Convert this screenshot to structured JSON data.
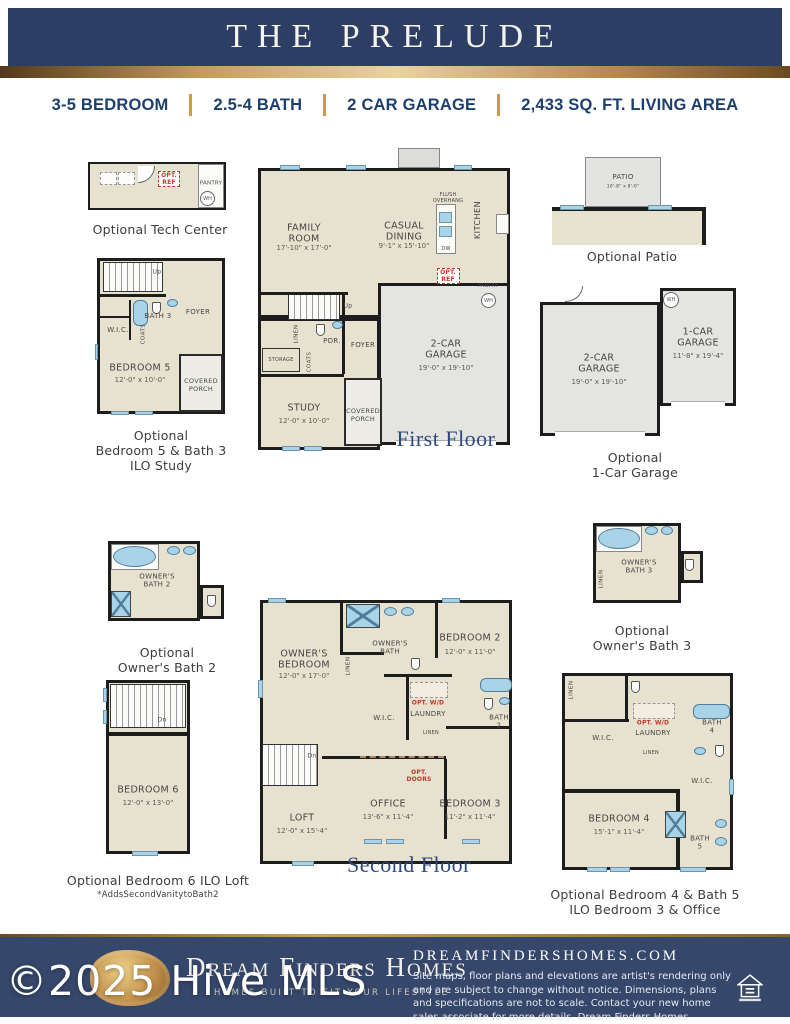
{
  "header": {
    "title": "THE PRELUDE"
  },
  "specs": [
    "3-5 BEDROOM",
    "2.5-4 BATH",
    "2 CAR GARAGE",
    "2,433 SQ. FT. LIVING AREA"
  ],
  "floors": {
    "first": "First Floor",
    "second": "Second Floor"
  },
  "plans": {
    "tech": {
      "caption": "Optional Tech Center",
      "opt_ref": "OPT.\nREF",
      "pantry": "PANTRY",
      "wh": "WH"
    },
    "bed5": {
      "caption": "Optional\nBedroom 5 & Bath 3\nILO Study",
      "up": "Up",
      "bath": "BATH 3",
      "foyer": "FOYER",
      "wic": "W.I.C.",
      "coats": "COATS",
      "name": "BEDROOM 5",
      "dim": "12'-0\" x 10'-0\"",
      "porch": "COVERED\nPORCH"
    },
    "first": {
      "family": "FAMILY\nROOM",
      "family_dim": "17'-10\" x 17'-0\"",
      "dining": "CASUAL\nDINING",
      "dining_dim": "9'-1\" x 15'-10\"",
      "kitchen": "KITCHEN",
      "flush": "FLUSH\nOVERHANG",
      "dw": "DW",
      "opt_ref": "OPT.\nREF",
      "pantry": "PANTRY",
      "wh": "WH",
      "garage": "2-CAR\nGARAGE",
      "garage_dim": "19'-0\" x 19'-10\"",
      "linen": "LINEN",
      "pdr": "PDR.",
      "foyer": "FOYER",
      "storage": "STORAGE",
      "coats": "COATS",
      "study": "STUDY",
      "study_dim": "12'-0\" x 10'-0\"",
      "porch": "COVERED\nPORCH",
      "up": "Up"
    },
    "patio": {
      "caption": "Optional Patio",
      "name": "PATIO",
      "dim": "10'-8\" x 8'-0\""
    },
    "garage_opt": {
      "caption": "Optional\n1-Car Garage",
      "wh": "WH",
      "g2": "2-CAR\nGARAGE",
      "g2_dim": "19'-0\" x 19'-10\"",
      "g1": "1-CAR\nGARAGE",
      "g1_dim": "11'-8\" x 19'-4\""
    },
    "obath2": {
      "caption": "Optional\nOwner's Bath 2",
      "name": "OWNER'S\nBATH 2"
    },
    "bed6": {
      "caption": "Optional Bedroom 6 ILO Loft",
      "note": "*AddsSecondVanitytoBath2",
      "dn": "Dn",
      "name": "BEDROOM 6",
      "dim": "12'-0\" x 13'-0\""
    },
    "second": {
      "owner": "OWNER'S\nBEDROOM",
      "owner_dim": "12'-0\" x 17'-0\"",
      "obath": "OWNER'S\nBATH",
      "linen1": "LINEN",
      "bed2": "BEDROOM 2",
      "bed2_dim": "12'-0\" x 11'-0\"",
      "optwd": "OPT. W/D",
      "laundry": "LAUNDRY",
      "wic": "W.I.C.",
      "linen2": "LINEN",
      "bath2": "BATH\n2",
      "dn": "Dn",
      "loft": "LOFT",
      "loft_dim": "12'-0\" x 15'-4\"",
      "office": "OFFICE",
      "office_dim": "13'-6\" x 11'-4\"",
      "optdoors": "OPT.\nDOORS",
      "bed3": "BEDROOM 3",
      "bed3_dim": "11'-2\" x 11'-4\""
    },
    "obath3": {
      "caption": "Optional\nOwner's Bath 3",
      "name": "OWNER'S\nBATH 3",
      "linen": "LINEN"
    },
    "bed4": {
      "caption": "Optional Bedroom 4 & Bath 5\nILO Bedroom 3 & Office",
      "linen1": "LINEN",
      "wic1": "W.I.C.",
      "optwd": "OPT. W/D",
      "laundry": "LAUNDRY",
      "linen2": "LINEN",
      "bath4": "BATH\n4",
      "wic2": "W.I.C.",
      "name": "BEDROOM 4",
      "dim": "15'-1\" x 11'-4\"",
      "bath5": "BATH\n5"
    }
  },
  "footer": {
    "brand": "Dream Finders Homes",
    "tagline": "HOMES BUILT TO FIT YOUR LIFESTYLE",
    "website": "DREAMFINDERSHOMES.COM",
    "disclaimer": "Site maps, floor plans and elevations are artist's rendering only and are subject to change without notice. Dimensions, plans and specifications are not to scale. Contact your new home sales associate for more details. Dream Finders Homes CBC1252734"
  },
  "watermark": "©2025 Hive MLS",
  "colors": {
    "navy": "#2c3e63",
    "gold": "#cf9c42",
    "red": "#c0392b",
    "window_blue": "#a9d3e6",
    "floor_tan": "#e7e2d0"
  }
}
